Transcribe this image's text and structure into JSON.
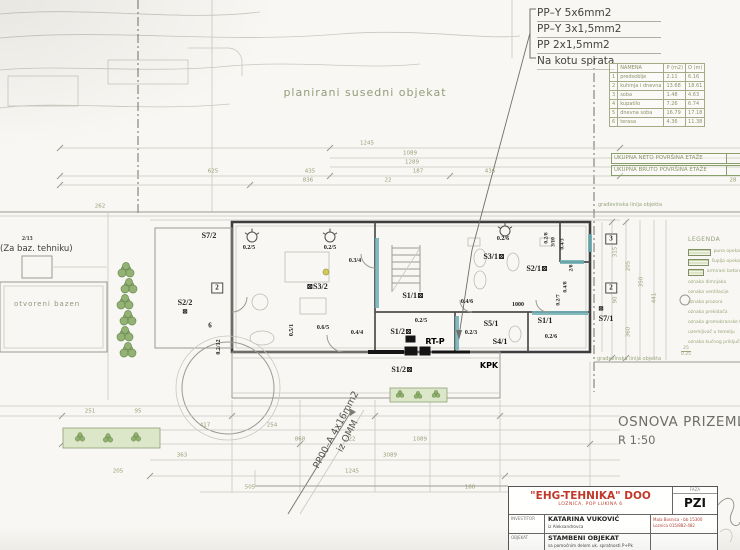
{
  "top_right_notes": {
    "lines": [
      "PP–Y 5x6mm2",
      "PP–Y 3x1,5mm2",
      "PP 2x1,5mm2"
    ],
    "footer": "Na kotu sprata"
  },
  "area_table": {
    "headers": [
      "",
      "NAMENA",
      "P (m2)",
      "O (m)"
    ],
    "rows": [
      [
        "1",
        "predsoblje",
        "2.11",
        "6.16"
      ],
      [
        "2",
        "kuhinja i dnevna",
        "13.68",
        "18.61"
      ],
      [
        "3",
        "soba",
        "1.48",
        "4.63"
      ],
      [
        "4",
        "kupatilo",
        "7.26",
        "6.74"
      ],
      [
        "5",
        "dnevna soba",
        "16.79",
        "17.18"
      ],
      [
        "6",
        "terasa",
        "4.36",
        "11.38"
      ]
    ]
  },
  "totals": {
    "neto": "UKUPNA NETO POVRŠINA ETAŽE",
    "bruto": "UKUPNA BRUTO POVRŠINA ETAŽE"
  },
  "site": {
    "neighbor": "planirani susedni objekat",
    "pool_num": "2/13",
    "pool_note": "(Za baz. tehniku)",
    "pool_label": "otvoreni bazen",
    "building_line_top": "građevinska linija objekta",
    "building_line_bottom": "građevinska linija objekta"
  },
  "drawing_title": {
    "name": "OSNOVA PRIZEMLJA",
    "scale": "R 1:50"
  },
  "cable_note": {
    "line1": "PP00–A 4x16mm2",
    "line2": "iz OMM"
  },
  "legend": {
    "title": "LEGENDA",
    "swatches": [
      "puna opeka",
      "šuplja opeka",
      "armirani beton"
    ],
    "items": [
      "oznaka dimnjaka",
      "oznaka ventilacije",
      "oznaka prozora",
      "oznaka prekidača",
      "oznaka gromobranske trake",
      "uzemljivač u temelju",
      "oznaka kućnog priključka"
    ],
    "mark_top": "25",
    "mark_bottom": "0.25"
  },
  "title_block": {
    "company": "\"EHG-TEHNIKA\" DOO",
    "company_sub": "LOZNICA, POP LUKINA 6",
    "phase_label": "FAZA",
    "phase": "PZI",
    "row2_label": "INVESTITOR",
    "investor": "KATARINA VUKOVIĆ",
    "investor_sub": "iz Aleksandrovca",
    "address1": "Mala Bosnica - bb 15300",
    "address2": "Loznica 015/882-482",
    "row3_label": "OBJEKAT",
    "object": "STAMBENI OBJEKAT",
    "object_sub": "sa pomoćnim delom uk. spratnosti P+Pk"
  },
  "plan_labels": [
    {
      "t": "S7/2",
      "x": 209,
      "y": 236
    },
    {
      "t": "0.2/5",
      "x": 249,
      "y": 248,
      "s": 6
    },
    {
      "t": "0.2/5",
      "x": 330,
      "y": 248,
      "s": 6
    },
    {
      "t": "0.3/4",
      "x": 355,
      "y": 261,
      "s": 6
    },
    {
      "t": "⊠S3/2",
      "x": 317,
      "y": 287
    },
    {
      "t": "2",
      "x": 217,
      "y": 288,
      "c": "bx",
      "s": 7
    },
    {
      "t": "S2/2",
      "x": 185,
      "y": 303
    },
    {
      "t": "⊠",
      "x": 185,
      "y": 312,
      "s": 7
    },
    {
      "t": "6",
      "x": 210,
      "y": 326,
      "s": 7
    },
    {
      "t": "0.5/1",
      "x": 292,
      "y": 330,
      "r": -90,
      "s": 6
    },
    {
      "t": "0.6/5",
      "x": 323,
      "y": 328,
      "s": 6
    },
    {
      "t": "0.4/4",
      "x": 357,
      "y": 333,
      "s": 6
    },
    {
      "t": "0.2/12",
      "x": 219,
      "y": 347,
      "r": -90,
      "s": 6
    },
    {
      "t": "S1/1⊠",
      "x": 413,
      "y": 296
    },
    {
      "t": "0.2/5",
      "x": 421,
      "y": 321,
      "s": 6
    },
    {
      "t": "S1/2⊠",
      "x": 401,
      "y": 332
    },
    {
      "t": "RT-P",
      "x": 435,
      "y": 342,
      "c": "b"
    },
    {
      "t": "S1/2⊠",
      "x": 402,
      "y": 370
    },
    {
      "t": "0.2/6",
      "x": 503,
      "y": 239,
      "s": 6
    },
    {
      "t": "S3/1⊠",
      "x": 494,
      "y": 257
    },
    {
      "t": "S2/1⊠",
      "x": 537,
      "y": 269
    },
    {
      "t": "0.4/6",
      "x": 467,
      "y": 302,
      "s": 6
    },
    {
      "t": "1000",
      "x": 518,
      "y": 305,
      "s": 6
    },
    {
      "t": "S5/1",
      "x": 491,
      "y": 324
    },
    {
      "t": "0.2/3",
      "x": 471,
      "y": 333,
      "s": 6
    },
    {
      "t": "S4/1",
      "x": 500,
      "y": 342
    },
    {
      "t": "S1/1",
      "x": 545,
      "y": 321
    },
    {
      "t": "0.2/6",
      "x": 551,
      "y": 337,
      "s": 6
    },
    {
      "t": "KPK",
      "x": 489,
      "y": 366,
      "c": "b"
    },
    {
      "t": "0.2/7",
      "x": 559,
      "y": 300,
      "r": -90,
      "s": 5.5
    },
    {
      "t": "0.4/8",
      "x": 566,
      "y": 287,
      "r": -90,
      "s": 5.5
    },
    {
      "t": "2/8",
      "x": 572,
      "y": 268,
      "r": -90,
      "s": 5.5
    },
    {
      "t": "0.4/3",
      "x": 563,
      "y": 244,
      "r": -90,
      "s": 5.5
    },
    {
      "t": "3/10",
      "x": 554,
      "y": 242,
      "r": -90,
      "s": 5.5
    },
    {
      "t": "0.2/8",
      "x": 547,
      "y": 238,
      "r": -90,
      "s": 5.5
    },
    {
      "t": "⊠",
      "x": 601,
      "y": 309,
      "s": 7
    },
    {
      "t": "S7/1",
      "x": 606,
      "y": 319
    },
    {
      "t": "3",
      "x": 611,
      "y": 239,
      "c": "bx",
      "s": 7
    },
    {
      "t": "2",
      "x": 611,
      "y": 288,
      "c": "bx",
      "s": 7
    }
  ],
  "dims": [
    {
      "t": "1245",
      "x": 367,
      "y": 144
    },
    {
      "t": "1089",
      "x": 410,
      "y": 154
    },
    {
      "t": "1289",
      "x": 412,
      "y": 163
    },
    {
      "t": "625",
      "x": 213,
      "y": 172
    },
    {
      "t": "435",
      "x": 310,
      "y": 172
    },
    {
      "t": "187",
      "x": 418,
      "y": 172
    },
    {
      "t": "436",
      "x": 490,
      "y": 172
    },
    {
      "t": "836",
      "x": 308,
      "y": 181
    },
    {
      "t": "22",
      "x": 388,
      "y": 181
    },
    {
      "t": "28",
      "x": 733,
      "y": 181
    },
    {
      "t": "262",
      "x": 100,
      "y": 207
    },
    {
      "t": "315",
      "x": 616,
      "y": 252,
      "r": -90
    },
    {
      "t": "205",
      "x": 629,
      "y": 266,
      "r": -90
    },
    {
      "t": "90",
      "x": 616,
      "y": 300,
      "r": -90
    },
    {
      "t": "350",
      "x": 642,
      "y": 282,
      "r": -90
    },
    {
      "t": "441",
      "x": 655,
      "y": 298,
      "r": -90
    },
    {
      "t": "360",
      "x": 629,
      "y": 332,
      "r": -90
    },
    {
      "t": "251",
      "x": 90,
      "y": 412
    },
    {
      "t": "95",
      "x": 138,
      "y": 412
    },
    {
      "t": "417",
      "x": 205,
      "y": 426
    },
    {
      "t": "254",
      "x": 272,
      "y": 426
    },
    {
      "t": "868",
      "x": 300,
      "y": 440
    },
    {
      "t": "22",
      "x": 352,
      "y": 440
    },
    {
      "t": "1089",
      "x": 420,
      "y": 440
    },
    {
      "t": "363",
      "x": 182,
      "y": 456
    },
    {
      "t": "3089",
      "x": 390,
      "y": 456
    },
    {
      "t": "205",
      "x": 118,
      "y": 472
    },
    {
      "t": "1245",
      "x": 352,
      "y": 472
    },
    {
      "t": "505",
      "x": 250,
      "y": 488
    },
    {
      "t": "160",
      "x": 470,
      "y": 488
    }
  ],
  "trees": [
    {
      "x": 126,
      "y": 270,
      "s": 1
    },
    {
      "x": 129,
      "y": 286,
      "s": 1
    },
    {
      "x": 125,
      "y": 302,
      "s": 1
    },
    {
      "x": 128,
      "y": 318,
      "s": 1
    },
    {
      "x": 125,
      "y": 334,
      "s": 1
    },
    {
      "x": 128,
      "y": 350,
      "s": 1
    },
    {
      "x": 80,
      "y": 437,
      "s": 0.6
    },
    {
      "x": 108,
      "y": 438,
      "s": 0.6
    },
    {
      "x": 136,
      "y": 437,
      "s": 0.6
    },
    {
      "x": 400,
      "y": 394,
      "s": 0.5
    },
    {
      "x": 418,
      "y": 395,
      "s": 0.5
    },
    {
      "x": 436,
      "y": 394,
      "s": 0.5
    }
  ],
  "lamps": [
    {
      "x": 252,
      "y": 237
    },
    {
      "x": 330,
      "y": 237
    },
    {
      "x": 505,
      "y": 231
    }
  ]
}
